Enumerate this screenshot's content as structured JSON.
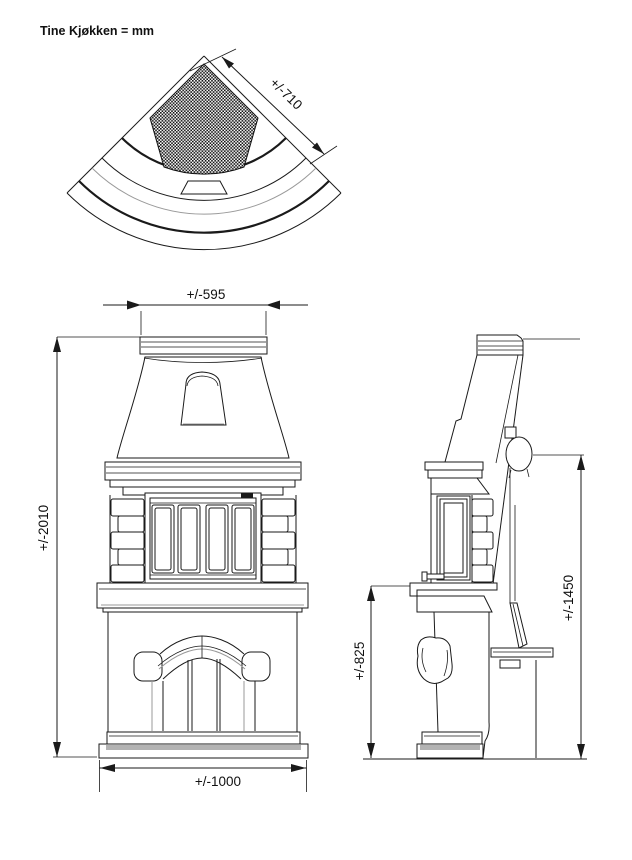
{
  "title": "Tine Kjøkken = mm",
  "units": "mm",
  "colors": {
    "line": "#1a1a1a",
    "shadow": "#b3b3b3"
  },
  "views": {
    "top": {
      "dim_depth": "+/-710"
    },
    "front": {
      "dim_top_width": "+/-595",
      "dim_total_height": "+/-2010",
      "dim_base_width": "+/-1000"
    },
    "side": {
      "dim_bench_height": "+/-825",
      "dim_flue_outlet_height": "+/-1450"
    }
  }
}
